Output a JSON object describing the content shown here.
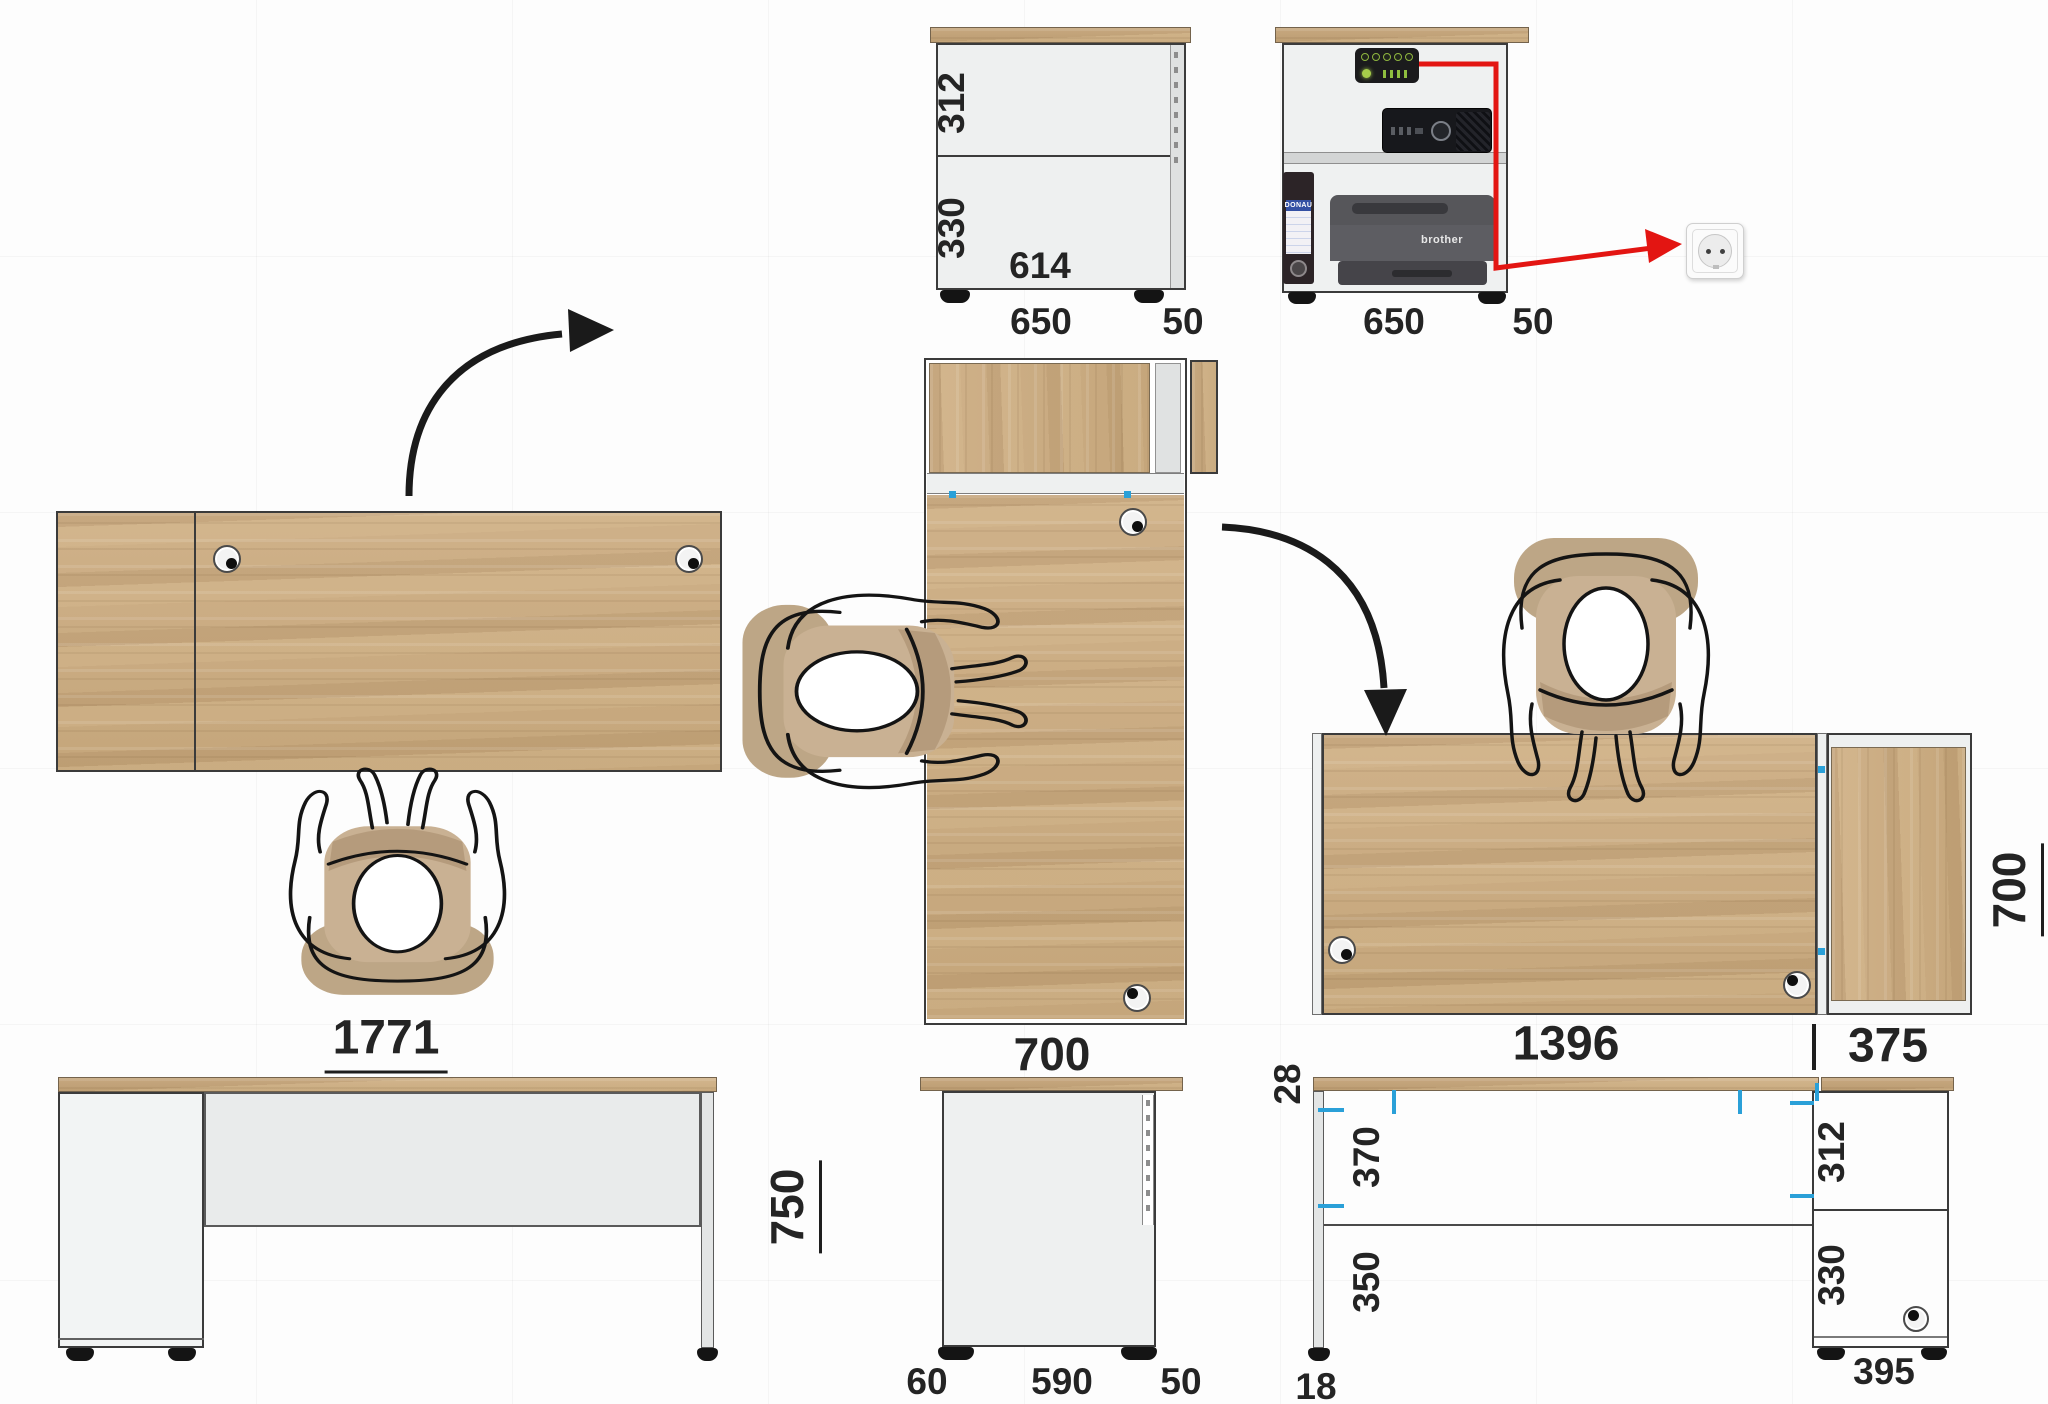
{
  "drawing": {
    "views": {
      "cabinet_section": {
        "top_section": "312",
        "bottom_section": "330",
        "inner_width": "614",
        "depth": "650",
        "door": "50"
      },
      "cabinet_equipment": {
        "depth": "650",
        "door": "50",
        "binder_brand": "DONAU",
        "printer_brand": "brother"
      },
      "desk_top": {
        "width": "1771"
      },
      "desk_side": {
        "title": "700",
        "back_offset": "60",
        "leg_depth": "590",
        "front_offset": "50"
      },
      "desk_front": {
        "height": "750"
      },
      "workstation_top": {
        "desk_width": "1396",
        "cabinet_width": "375",
        "depth": "700"
      },
      "workstation_front": {
        "top_thickness": "28",
        "apron_height": "370",
        "clearance": "350",
        "leg_thickness": "18",
        "cabinet_top_section": "312",
        "cabinet_bottom_section": "330",
        "cabinet_width": "395"
      }
    }
  }
}
